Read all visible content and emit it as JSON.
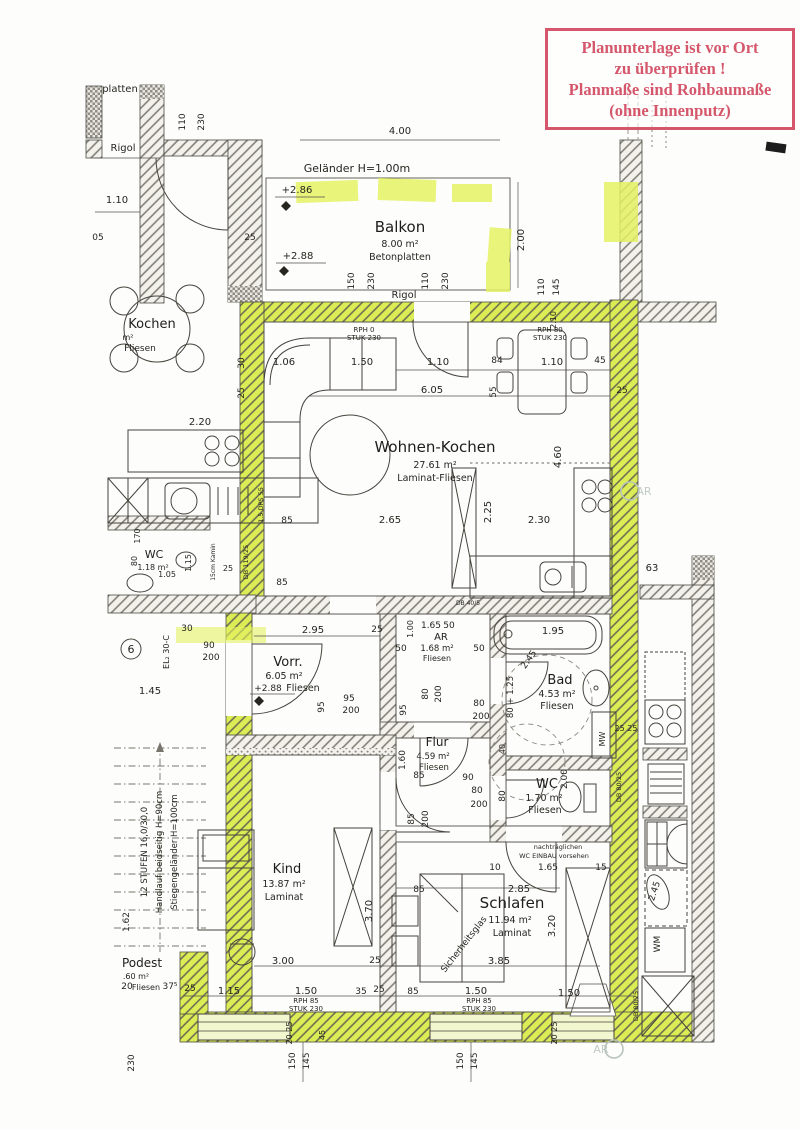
{
  "colors": {
    "highlight": "#dcec55",
    "stamp_red": "#d4576b",
    "ink": "#26251f"
  },
  "stamp": {
    "lines": [
      "Planunterlage ist vor Ort",
      "zu überprüfen !",
      "Planmaße sind Rohbaumaße",
      "(ohne Innenputz)"
    ]
  },
  "annotations": {
    "unit_number": "6"
  },
  "rooms": {
    "balkon": {
      "name": "Balkon",
      "area": "8.00 m²",
      "floor": "Betonplatten"
    },
    "wohnen": {
      "name": "Wohnen-Kochen",
      "area": "27.61 m²",
      "floor": "Laminat-Fliesen"
    },
    "vorraum": {
      "name": "Vorr.",
      "area": "6.05 m²",
      "floor": "Fliesen"
    },
    "ar": {
      "name": "AR",
      "area": "1.68 m²",
      "floor": "Fliesen"
    },
    "bad": {
      "name": "Bad",
      "area": "4.53 m²",
      "floor": "Fliesen"
    },
    "flur": {
      "name": "Flur",
      "area": "4.59 m²",
      "floor": "Fliesen"
    },
    "wc": {
      "name": "WC",
      "area": "1.70 m²",
      "floor": "Fliesen"
    },
    "kind": {
      "name": "Kind",
      "area": "13.87 m²",
      "floor": "Laminat"
    },
    "schlafen": {
      "name": "Schlafen",
      "area": "11.94 m²",
      "floor": "Laminat"
    },
    "wc_left": {
      "name": "WC",
      "area": "1.18 m²"
    },
    "kochen_left": {
      "name": "Kochen",
      "area": "m²",
      "floor": "Fliesen"
    },
    "podest": {
      "name": "Podest",
      "area": ".60 m²",
      "floor": "Fliesen"
    }
  },
  "dim_labels": [
    {
      "t": "platten",
      "x": 120,
      "y": 92,
      "s": 10
    },
    {
      "t": "Rigol",
      "x": 123,
      "y": 151,
      "s": 10
    },
    {
      "t": "110",
      "x": 185,
      "y": 122,
      "r": -90,
      "s": 9
    },
    {
      "t": "230",
      "x": 204,
      "y": 122,
      "r": -90,
      "s": 9
    },
    {
      "t": "4.00",
      "x": 400,
      "y": 134,
      "s": 10
    },
    {
      "t": "1.10",
      "x": 117,
      "y": 203,
      "s": 10
    },
    {
      "t": "05",
      "x": 98,
      "y": 240,
      "s": 9
    },
    {
      "t": "25",
      "x": 250,
      "y": 240,
      "s": 9
    },
    {
      "t": "Geländer  H=1.00m",
      "x": 357,
      "y": 172,
      "s": 11
    },
    {
      "t": "+2.86",
      "x": 297,
      "y": 193,
      "s": 10
    },
    {
      "t": "+2.88",
      "x": 298,
      "y": 259,
      "s": 10
    },
    {
      "t": "2.00",
      "x": 524,
      "y": 240,
      "r": -90,
      "s": 10
    },
    {
      "t": "150",
      "x": 354,
      "y": 281,
      "r": -90,
      "s": 9
    },
    {
      "t": "230",
      "x": 374,
      "y": 281,
      "r": -90,
      "s": 9
    },
    {
      "t": "110",
      "x": 428,
      "y": 281,
      "r": -90,
      "s": 9
    },
    {
      "t": "230",
      "x": 448,
      "y": 281,
      "r": -90,
      "s": 9
    },
    {
      "t": "Rigol",
      "x": 404,
      "y": 298,
      "s": 10
    },
    {
      "t": "110",
      "x": 544,
      "y": 287,
      "r": -90,
      "s": 9
    },
    {
      "t": "145",
      "x": 559,
      "y": 287,
      "r": -90,
      "s": 9
    },
    {
      "t": "RPH 0",
      "x": 364,
      "y": 332,
      "s": 7
    },
    {
      "t": "STUK 230",
      "x": 364,
      "y": 340,
      "s": 7
    },
    {
      "t": "RPH 80",
      "x": 550,
      "y": 332,
      "s": 7
    },
    {
      "t": "STUK 230",
      "x": 550,
      "y": 340,
      "s": 7
    },
    {
      "t": "1.06",
      "x": 284,
      "y": 365,
      "s": 10
    },
    {
      "t": "1.50",
      "x": 362,
      "y": 365,
      "s": 10
    },
    {
      "t": "1.10",
      "x": 438,
      "y": 365,
      "s": 10
    },
    {
      "t": "84",
      "x": 497,
      "y": 363,
      "s": 9
    },
    {
      "t": "1.10",
      "x": 552,
      "y": 365,
      "s": 10
    },
    {
      "t": "45",
      "x": 600,
      "y": 363,
      "s": 9
    },
    {
      "t": "6.05",
      "x": 432,
      "y": 393,
      "s": 10
    },
    {
      "t": "55",
      "x": 496,
      "y": 392,
      "r": -90,
      "s": 9
    },
    {
      "t": "25",
      "x": 622,
      "y": 393,
      "s": 9
    },
    {
      "t": "2.10",
      "x": 556,
      "y": 320,
      "r": -90,
      "s": 8
    },
    {
      "t": "4.60",
      "x": 561,
      "y": 457,
      "r": -90,
      "s": 10
    },
    {
      "t": "2.25",
      "x": 491,
      "y": 512,
      "r": -90,
      "s": 10
    },
    {
      "t": "85",
      "x": 287,
      "y": 523,
      "s": 9
    },
    {
      "t": "2.65",
      "x": 390,
      "y": 523,
      "s": 10
    },
    {
      "t": "2.30",
      "x": 539,
      "y": 523,
      "s": 10
    },
    {
      "t": "1.5 DPS 55",
      "x": 263,
      "y": 505,
      "r": -90,
      "s": 6.5
    },
    {
      "t": "DB 119/25",
      "x": 248,
      "y": 562,
      "r": -90,
      "s": 6.5
    },
    {
      "t": "15cm Kamin",
      "x": 215,
      "y": 562,
      "r": -90,
      "s": 6
    },
    {
      "t": "2.20",
      "x": 200,
      "y": 425,
      "s": 10
    },
    {
      "t": "30",
      "x": 244,
      "y": 363,
      "r": -90,
      "s": 9
    },
    {
      "t": "25",
      "x": 244,
      "y": 393,
      "r": -90,
      "s": 9
    },
    {
      "t": "1.05",
      "x": 167,
      "y": 577,
      "s": 8
    },
    {
      "t": "80",
      "x": 137,
      "y": 561,
      "r": -90,
      "s": 8
    },
    {
      "t": "170",
      "x": 140,
      "y": 536,
      "r": -90,
      "s": 8
    },
    {
      "t": "1.15",
      "x": 191,
      "y": 563,
      "r": -90,
      "s": 8
    },
    {
      "t": "25",
      "x": 228,
      "y": 571,
      "s": 8
    },
    {
      "t": "85",
      "x": 282,
      "y": 585,
      "s": 9
    },
    {
      "t": "DB 40/5",
      "x": 468,
      "y": 605,
      "s": 6
    },
    {
      "t": "30",
      "x": 187,
      "y": 631,
      "s": 9
    },
    {
      "t": "90",
      "x": 209,
      "y": 648,
      "s": 9
    },
    {
      "t": "200",
      "x": 211,
      "y": 660,
      "s": 9
    },
    {
      "t": "1.45",
      "x": 150,
      "y": 694,
      "s": 10
    },
    {
      "t": "EL₂ 30-C",
      "x": 169,
      "y": 652,
      "r": -90,
      "s": 8
    },
    {
      "t": "2.95",
      "x": 313,
      "y": 633,
      "s": 10
    },
    {
      "t": "25",
      "x": 377,
      "y": 632,
      "s": 9
    },
    {
      "t": "95",
      "x": 324,
      "y": 707,
      "r": -90,
      "s": 9
    },
    {
      "t": "95",
      "x": 349,
      "y": 701,
      "s": 9
    },
    {
      "t": "200",
      "x": 351,
      "y": 713,
      "s": 9
    },
    {
      "t": "+2.88",
      "x": 268,
      "y": 691,
      "s": 9
    },
    {
      "t": "1.00",
      "x": 413,
      "y": 629,
      "r": -90,
      "s": 8
    },
    {
      "t": "1.65",
      "x": 431,
      "y": 628,
      "s": 9
    },
    {
      "t": "50",
      "x": 449,
      "y": 628,
      "s": 9
    },
    {
      "t": "50",
      "x": 401,
      "y": 651,
      "s": 9
    },
    {
      "t": "50",
      "x": 479,
      "y": 651,
      "s": 9
    },
    {
      "t": "80",
      "x": 428,
      "y": 694,
      "r": -90,
      "s": 9
    },
    {
      "t": "200",
      "x": 441,
      "y": 694,
      "r": -90,
      "s": 9
    },
    {
      "t": "95",
      "x": 406,
      "y": 710,
      "r": -90,
      "s": 9
    },
    {
      "t": "80",
      "x": 479,
      "y": 706,
      "s": 9
    },
    {
      "t": "200",
      "x": 481,
      "y": 719,
      "s": 9
    },
    {
      "t": "80 + 1.25",
      "x": 513,
      "y": 697,
      "r": -90,
      "s": 8.5
    },
    {
      "t": "1.95",
      "x": 553,
      "y": 634,
      "s": 10
    },
    {
      "t": "2.45",
      "x": 531,
      "y": 661,
      "r": -55,
      "s": 9
    },
    {
      "t": "25 25",
      "x": 626,
      "y": 731,
      "s": 8
    },
    {
      "t": "MW",
      "x": 605,
      "y": 739,
      "r": -90,
      "s": 8
    },
    {
      "t": "1.60",
      "x": 405,
      "y": 760,
      "r": -90,
      "s": 9
    },
    {
      "t": "85",
      "x": 419,
      "y": 778,
      "s": 9
    },
    {
      "t": "90",
      "x": 468,
      "y": 780,
      "s": 9
    },
    {
      "t": "80",
      "x": 477,
      "y": 793,
      "s": 9
    },
    {
      "t": "200",
      "x": 479,
      "y": 807,
      "s": 9
    },
    {
      "t": "85",
      "x": 414,
      "y": 819,
      "r": -90,
      "s": 9
    },
    {
      "t": "200",
      "x": 428,
      "y": 819,
      "r": -90,
      "s": 9
    },
    {
      "t": "80",
      "x": 505,
      "y": 796,
      "r": -90,
      "s": 9
    },
    {
      "t": "40",
      "x": 505,
      "y": 749,
      "r": -90,
      "s": 8
    },
    {
      "t": "2.00",
      "x": 567,
      "y": 779,
      "r": -90,
      "s": 9
    },
    {
      "t": "nachträglichen",
      "x": 558,
      "y": 849,
      "s": 6.5
    },
    {
      "t": "WC EINBAU vorsehen",
      "x": 554,
      "y": 858,
      "s": 6.5
    },
    {
      "t": "1.65",
      "x": 548,
      "y": 870,
      "s": 9
    },
    {
      "t": "10",
      "x": 495,
      "y": 870,
      "s": 9
    },
    {
      "t": "15",
      "x": 601,
      "y": 870,
      "s": 9
    },
    {
      "t": "85",
      "x": 419,
      "y": 892,
      "s": 9
    },
    {
      "t": "2.85",
      "x": 519,
      "y": 892,
      "s": 10
    },
    {
      "t": "3.20",
      "x": 555,
      "y": 926,
      "r": -90,
      "s": 10
    },
    {
      "t": "3.85",
      "x": 499,
      "y": 964,
      "s": 10
    },
    {
      "t": "Sicherheitsglas",
      "x": 466,
      "y": 946,
      "r": -52,
      "s": 9
    },
    {
      "t": "85",
      "x": 413,
      "y": 994,
      "s": 9
    },
    {
      "t": "1.50",
      "x": 476,
      "y": 994,
      "s": 10
    },
    {
      "t": "1.50",
      "x": 569,
      "y": 996,
      "s": 10
    },
    {
      "t": "RPH 85",
      "x": 479,
      "y": 1003,
      "s": 7
    },
    {
      "t": "STUK 230",
      "x": 479,
      "y": 1011,
      "s": 7
    },
    {
      "t": "3.70",
      "x": 372,
      "y": 911,
      "r": -90,
      "s": 10
    },
    {
      "t": "3.00",
      "x": 283,
      "y": 964,
      "s": 10
    },
    {
      "t": "25",
      "x": 375,
      "y": 963,
      "s": 9
    },
    {
      "t": "1.15",
      "x": 229,
      "y": 994,
      "s": 10
    },
    {
      "t": "1.50",
      "x": 306,
      "y": 994,
      "s": 10
    },
    {
      "t": "RPH 85",
      "x": 306,
      "y": 1003,
      "s": 7
    },
    {
      "t": "STUK 230",
      "x": 306,
      "y": 1011,
      "s": 7
    },
    {
      "t": "35",
      "x": 361,
      "y": 994,
      "s": 9
    },
    {
      "t": "25",
      "x": 379,
      "y": 992,
      "s": 9
    },
    {
      "t": "20 25",
      "x": 292,
      "y": 1033,
      "r": -90,
      "s": 8
    },
    {
      "t": "45",
      "x": 325,
      "y": 1035,
      "r": -90,
      "s": 8
    },
    {
      "t": "150",
      "x": 295,
      "y": 1061,
      "r": -90,
      "s": 9
    },
    {
      "t": "145",
      "x": 309,
      "y": 1061,
      "r": -90,
      "s": 9
    },
    {
      "t": "150",
      "x": 463,
      "y": 1061,
      "r": -90,
      "s": 9
    },
    {
      "t": "145",
      "x": 477,
      "y": 1061,
      "r": -90,
      "s": 9
    },
    {
      "t": "20 25",
      "x": 557,
      "y": 1033,
      "r": -90,
      "s": 8
    },
    {
      "t": "DB 80/25",
      "x": 621,
      "y": 787,
      "r": -90,
      "s": 6.5
    },
    {
      "t": "DB 80/25",
      "x": 638,
      "y": 1006,
      "r": -90,
      "s": 6.5
    },
    {
      "t": "12 STUFEN 16,0/30,0",
      "x": 147,
      "y": 852,
      "r": -90,
      "s": 8.5
    },
    {
      "t": "Handlauf beidseitig H=90cm",
      "x": 162,
      "y": 852,
      "r": -90,
      "s": 8.5
    },
    {
      "t": "Stiegengeländer H=100cm",
      "x": 177,
      "y": 852,
      "r": -90,
      "s": 8.5
    },
    {
      "t": "1.62",
      "x": 129,
      "y": 922,
      "r": -90,
      "s": 9
    },
    {
      "t": "37⁵",
      "x": 170,
      "y": 989,
      "s": 9
    },
    {
      "t": "25",
      "x": 190,
      "y": 991,
      "s": 9
    },
    {
      "t": "20",
      "x": 127,
      "y": 989,
      "s": 9
    },
    {
      "t": "230",
      "x": 134,
      "y": 1063,
      "r": -90,
      "s": 9
    },
    {
      "t": "63",
      "x": 652,
      "y": 571,
      "s": 10
    },
    {
      "t": "2.45",
      "x": 657,
      "y": 892,
      "r": -72,
      "s": 9
    },
    {
      "t": "WM",
      "x": 660,
      "y": 944,
      "r": -90,
      "s": 9
    },
    {
      "t": "AR",
      "x": 644,
      "y": 495,
      "s": 11,
      "c": "wm"
    },
    {
      "t": "AR",
      "x": 601,
      "y": 1053,
      "s": 11,
      "c": "wm"
    }
  ]
}
